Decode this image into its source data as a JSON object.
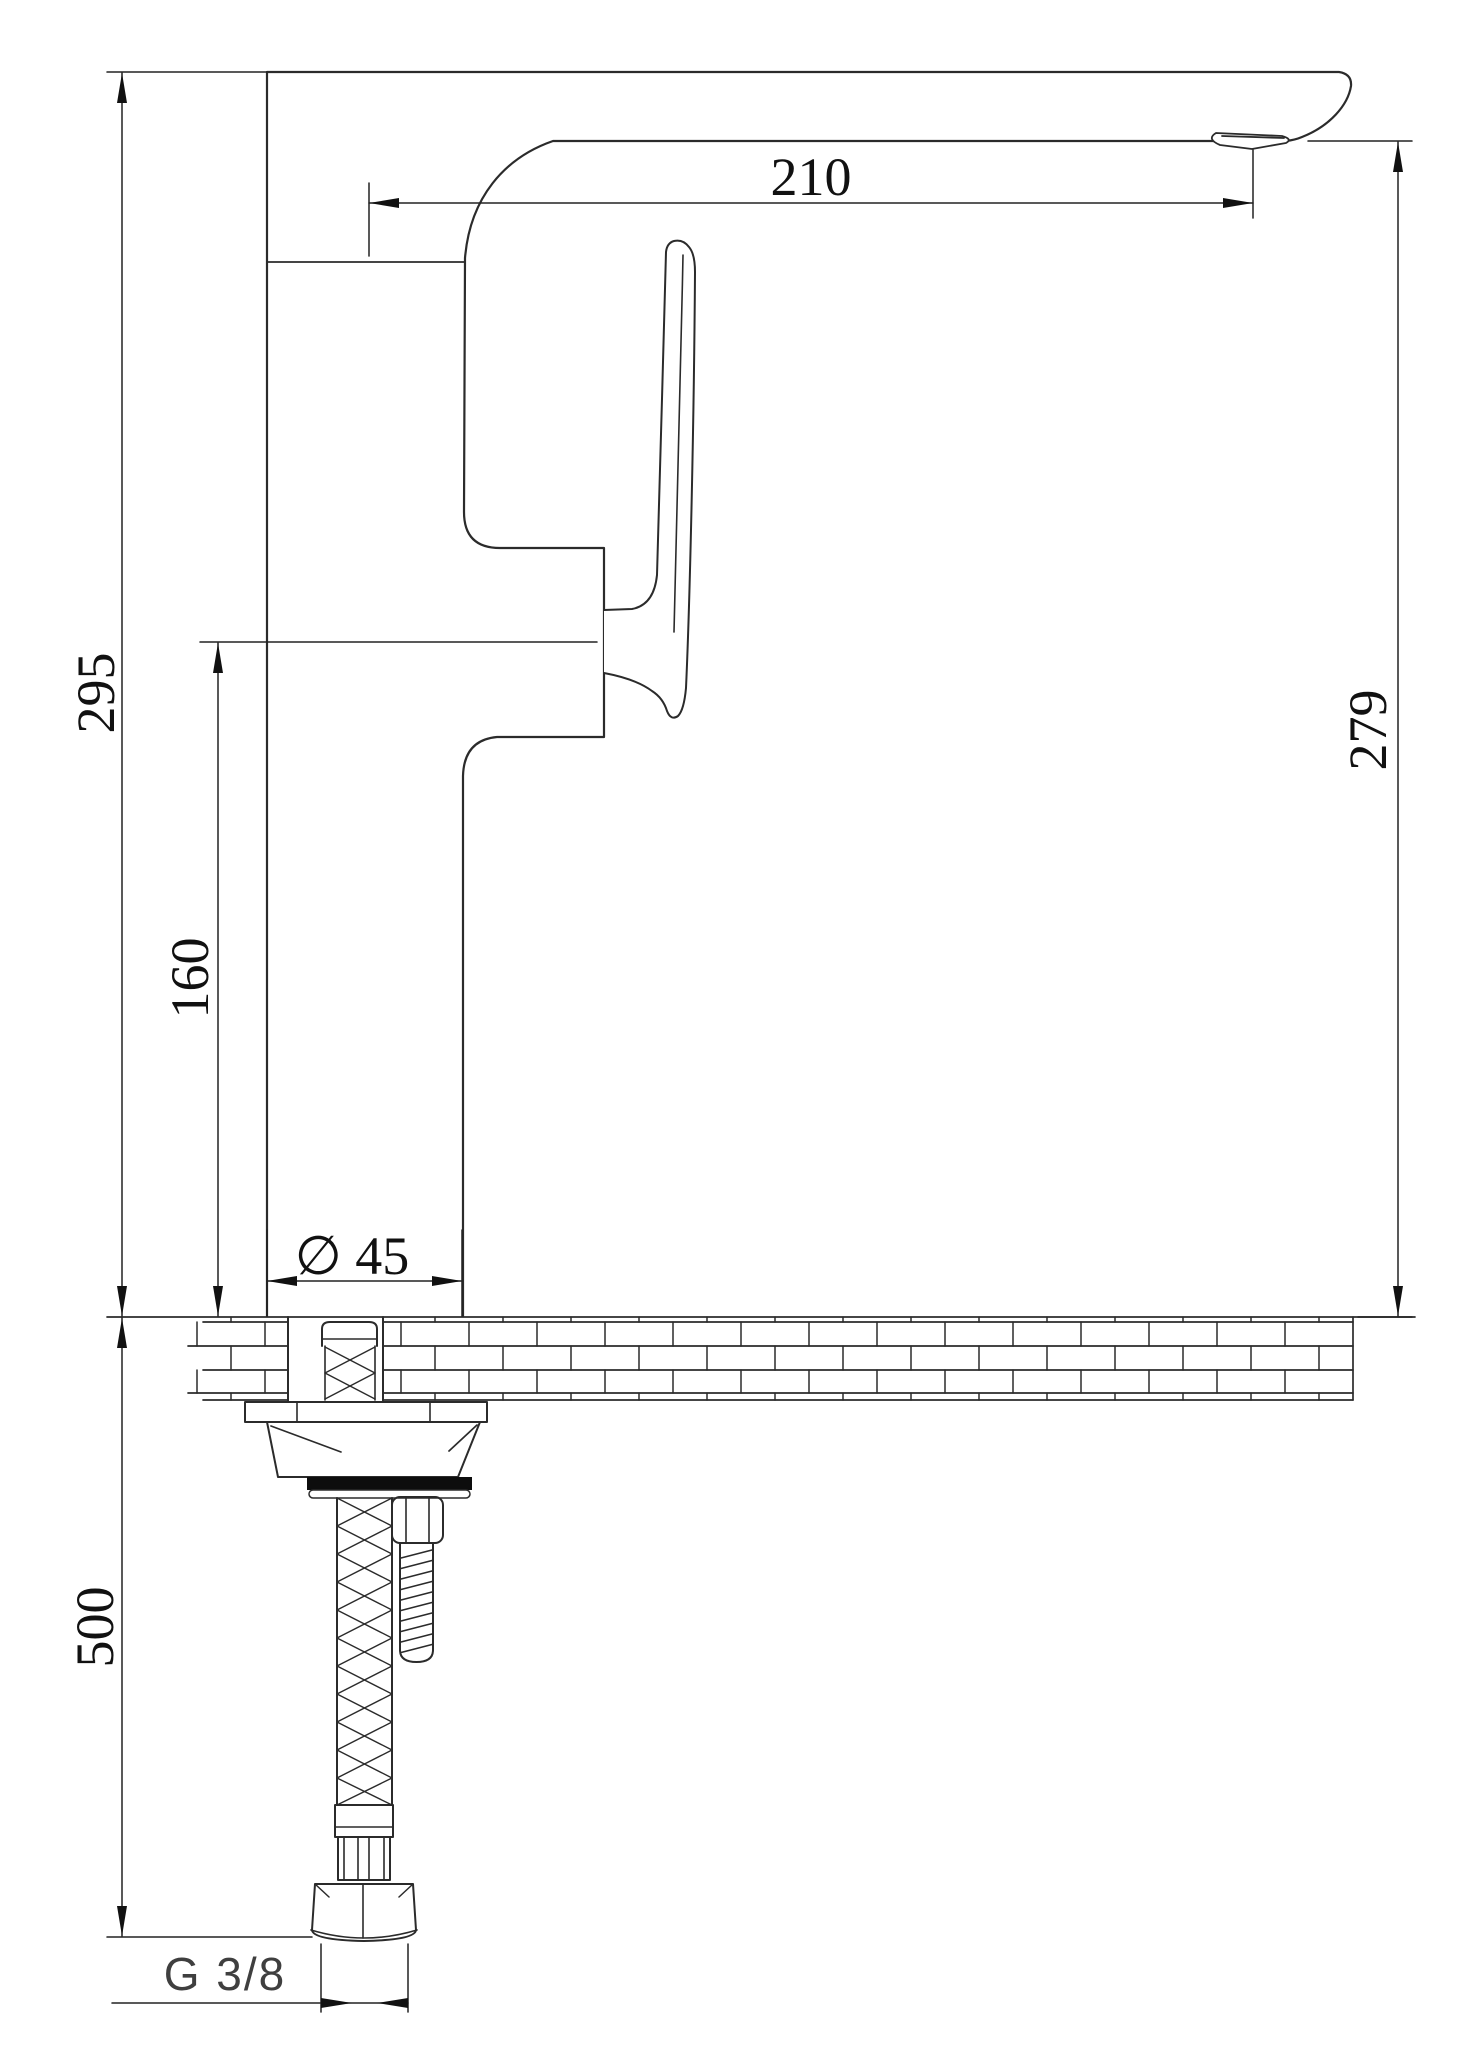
{
  "labels": {
    "spout_reach": "210",
    "overall_height": "295",
    "base_to_handle": "160",
    "spout_height": "279",
    "base_diameter": "∅ 45",
    "hose_length": "500",
    "thread_size": "G 3/8"
  }
}
